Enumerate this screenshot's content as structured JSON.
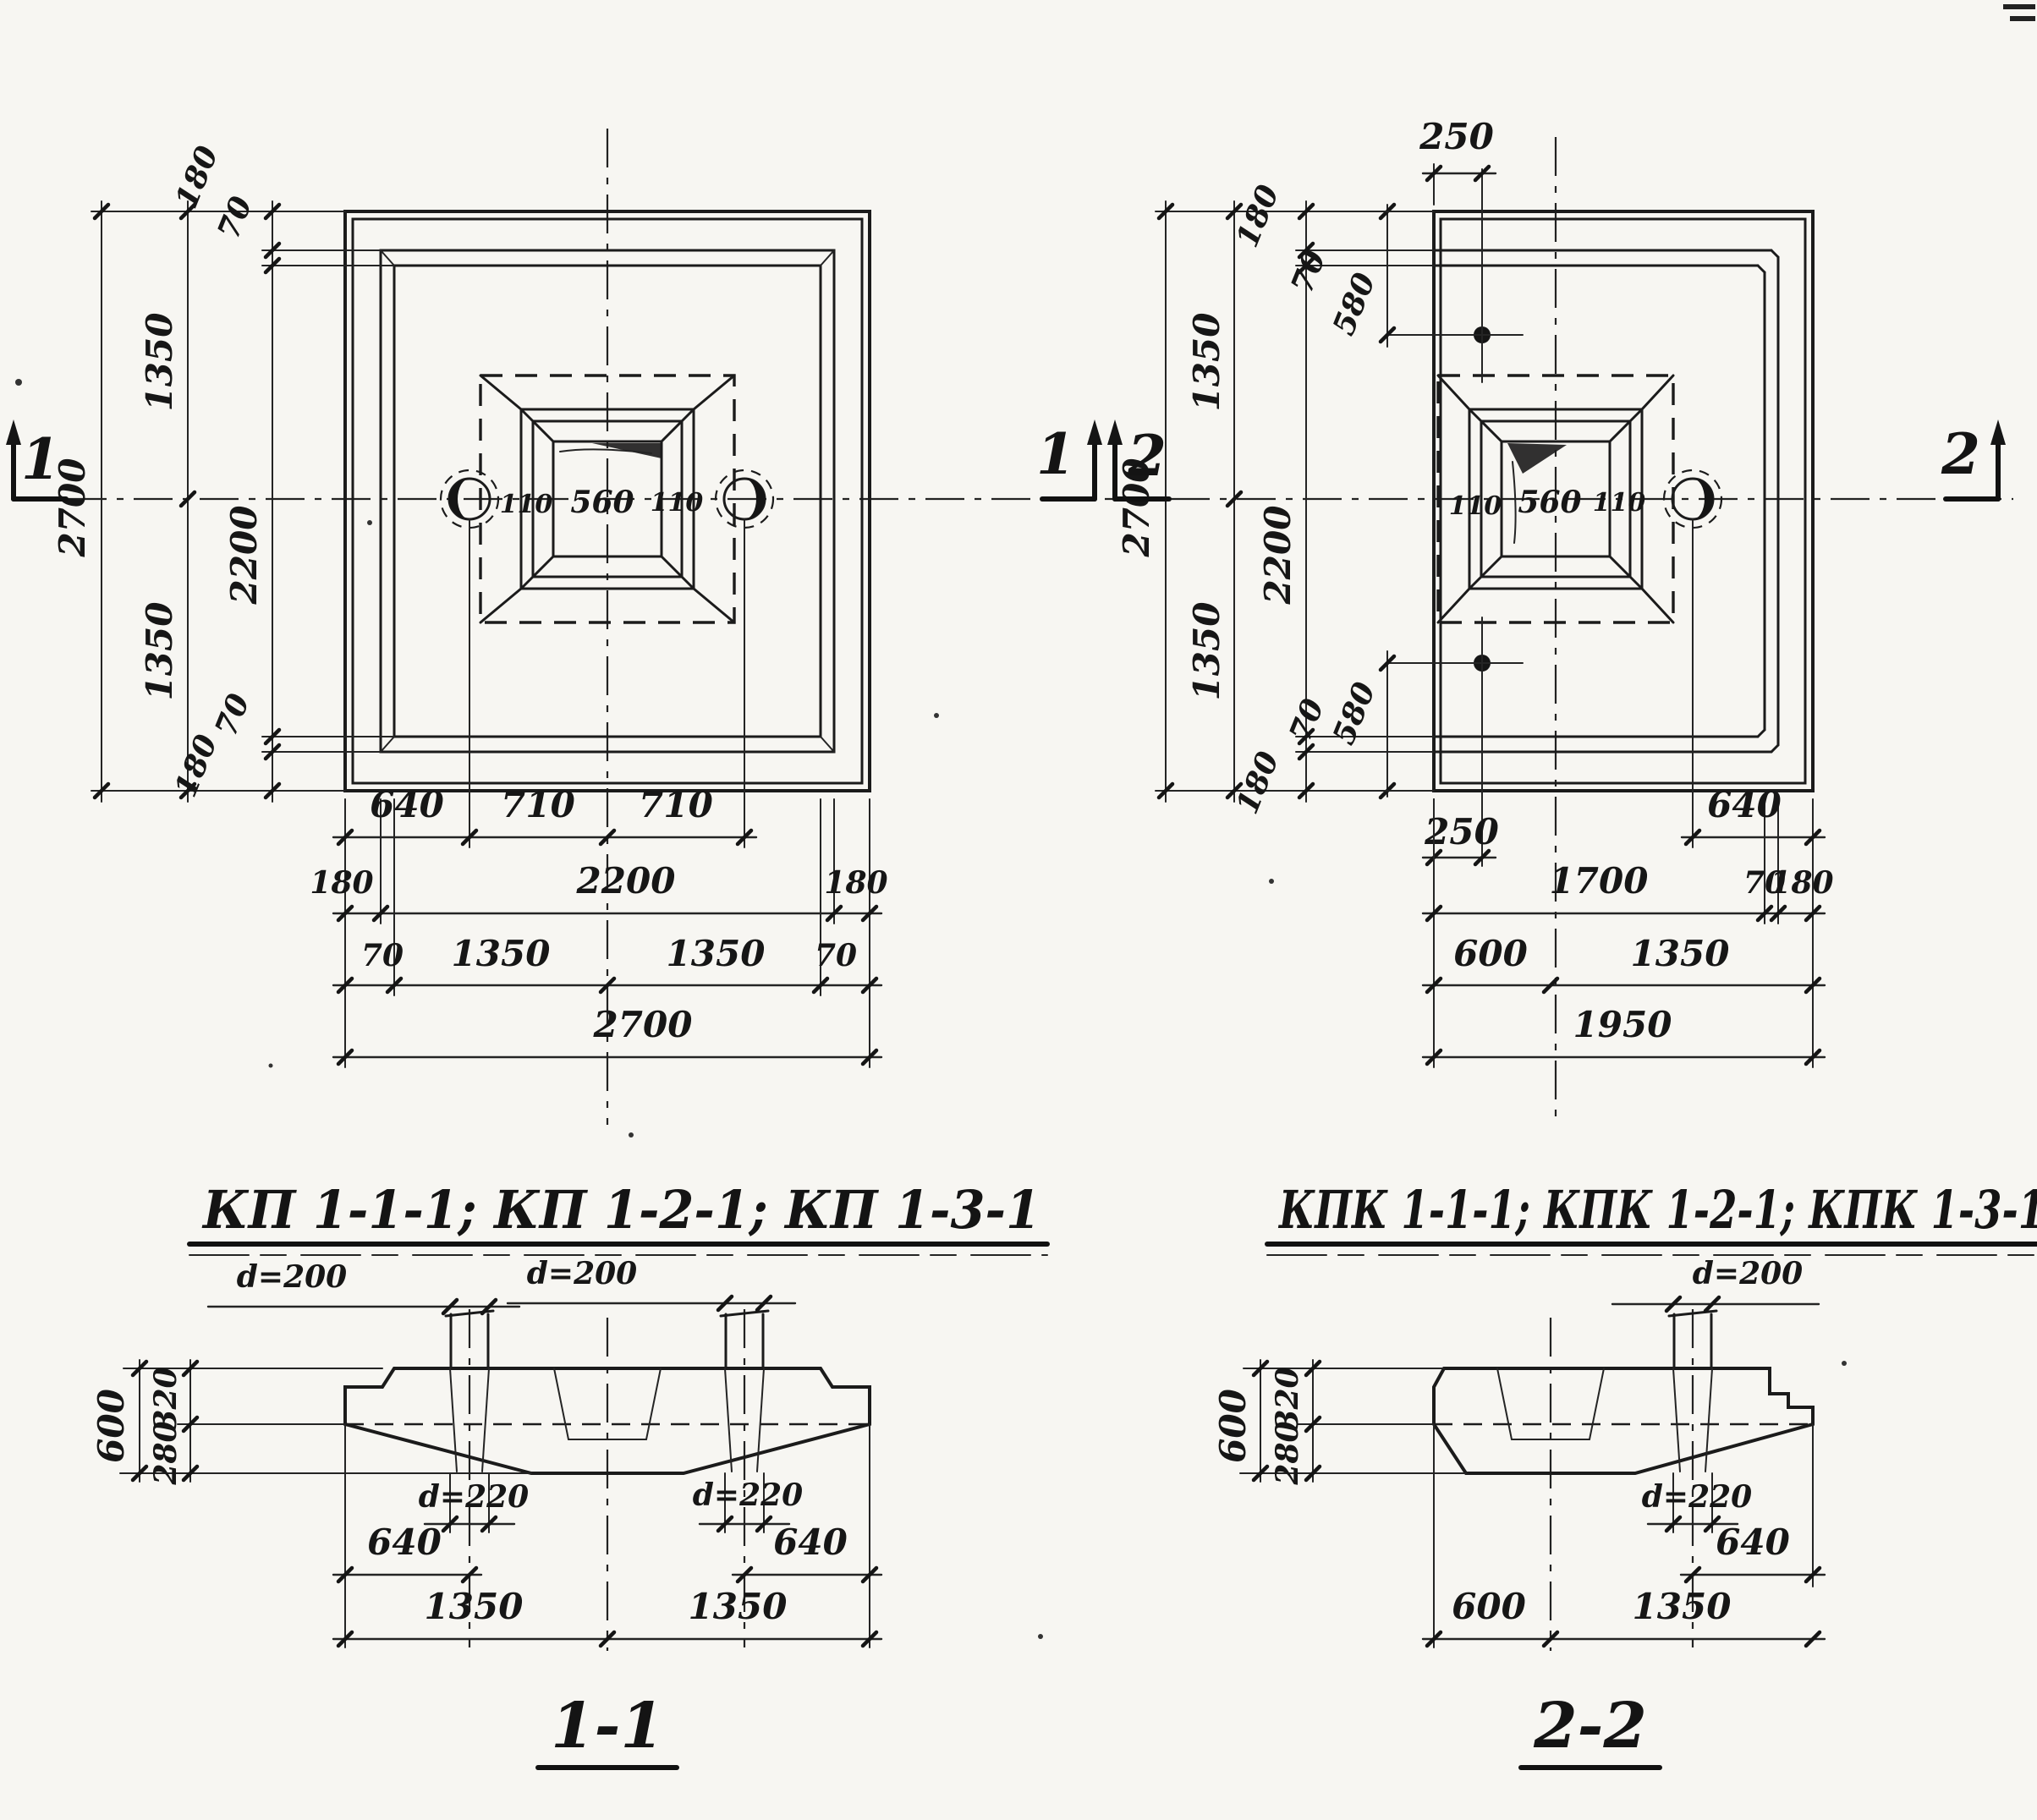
{
  "leftPlan": {
    "sectionMarker": "1",
    "colDims": {
      "total": "2700",
      "upper": "1350",
      "lower": "1350",
      "mid": "2200",
      "top180": "180",
      "top70": "70",
      "bot70": "70",
      "bot180": "180"
    },
    "socket": {
      "left": "110",
      "width": "560",
      "right": "110"
    },
    "rowLoops": [
      "640",
      "710",
      "710"
    ],
    "rowEdge": [
      "180",
      "2200",
      "180"
    ],
    "rowHalf": [
      "70",
      "1350",
      "1350",
      "70"
    ],
    "rowTotal": "2700"
  },
  "rightPlan": {
    "sectionMarker": "2",
    "colDims": {
      "total": "2700",
      "upper": "1350",
      "lower": "1350",
      "mid": "2200",
      "top180": "180",
      "top70": "70",
      "top580": "580",
      "bot580": "580",
      "bot70": "70",
      "bot180": "180"
    },
    "anchorTop": {
      "offset": "250"
    },
    "anchorBottom": {
      "offset": "250"
    },
    "socket": {
      "left": "110",
      "width": "560",
      "right": "110"
    },
    "rowLoop": "640",
    "rowEdge": [
      "1700",
      "70",
      "180"
    ],
    "rowHalf": [
      "600",
      "1350"
    ],
    "rowTotal": "1950"
  },
  "sectionLeft": {
    "title": "КП 1-1-1; КП 1-2-1; КП 1-3-1",
    "label": "1-1",
    "pileTop": {
      "left": "d=200",
      "right": "d=200"
    },
    "holes": {
      "left": "d=220",
      "right": "d=220"
    },
    "heights": {
      "total": "600",
      "slab": "320",
      "taper": "280"
    },
    "offsets": {
      "left640": "640",
      "right640": "640",
      "left1350": "1350",
      "right1350": "1350"
    }
  },
  "sectionRight": {
    "title": "КПК 1-1-1; КПК 1-2-1; КПК 1-3-1",
    "label": "2-2",
    "pileTop": "d=200",
    "hole": "d=220",
    "heights": {
      "total": "600",
      "slab": "320",
      "taper": "280"
    },
    "offsets": {
      "x640": "640",
      "x600": "600",
      "x1350": "1350"
    }
  }
}
